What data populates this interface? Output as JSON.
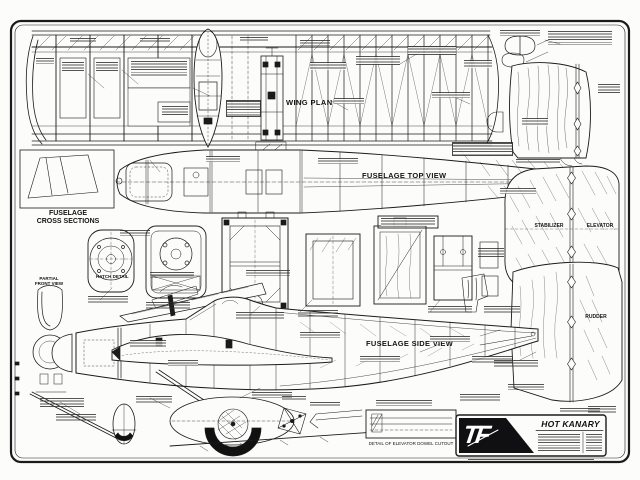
{
  "labels": {
    "wing_plan": "WING PLAN",
    "fuselage_top_view": "FUSELAGE TOP VIEW",
    "fuselage_cross_sections": "FUSELAGE\nCROSS SECTIONS",
    "fuselage_side_view": "FUSELAGE SIDE VIEW",
    "stabilizer": "STABILIZER",
    "elevator": "ELEVATOR",
    "rudder": "RUDDER",
    "hatch_detail": "HATCH DETAIL",
    "partial_front_view": "PARTIAL\nFRONT VIEW",
    "elevator_dowel_detail": "DETAIL OF ELEVATOR DOWEL CUTOUT"
  },
  "title_block": {
    "logo_text": "TF",
    "plan_title": "HOT KANARY"
  },
  "colors": {
    "ink": "#1b1b1d",
    "paper": "#fcfcfa"
  }
}
